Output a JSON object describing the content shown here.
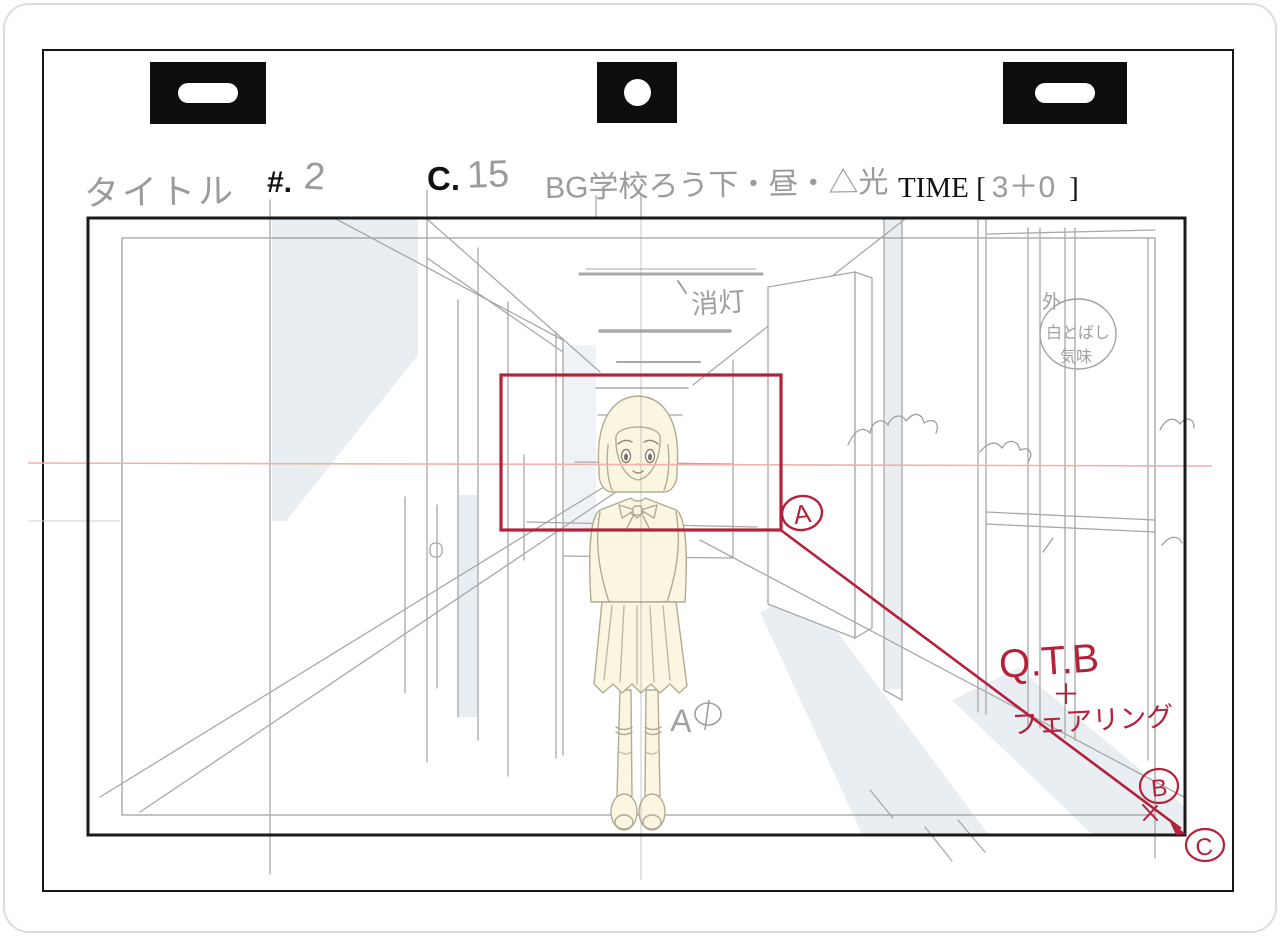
{
  "sheet": {
    "header": {
      "title_label": "タイトル",
      "cut_prefix": "#.",
      "cut_value": "2",
      "scene_prefix": "C.",
      "scene_value": "15",
      "bg_note": "BG学校ろう下・昼・△光",
      "time_prefix": "TIME [",
      "time_value": "3＋0",
      "time_suffix": "]"
    },
    "annotations": {
      "lights_off": "消灯",
      "window_note_outside": "外",
      "window_note_line1": "白とばし",
      "window_note_line2": "気味",
      "cel_label": "A①",
      "cel_letter": "A",
      "camera_move": "Q.T.B",
      "camera_plus": "＋",
      "camera_fairing": "フェアリング",
      "marker_a": "A",
      "marker_b": "B",
      "marker_c": "C"
    },
    "colors": {
      "camera_red": "#b5203a",
      "horizon_pink": "#f0b2ab",
      "sketch_gray": "#a8a8a8",
      "shade_blue": "#e8eef1",
      "cel_cream": "#faf6e2",
      "frame_black": "#1a1a1a"
    }
  }
}
